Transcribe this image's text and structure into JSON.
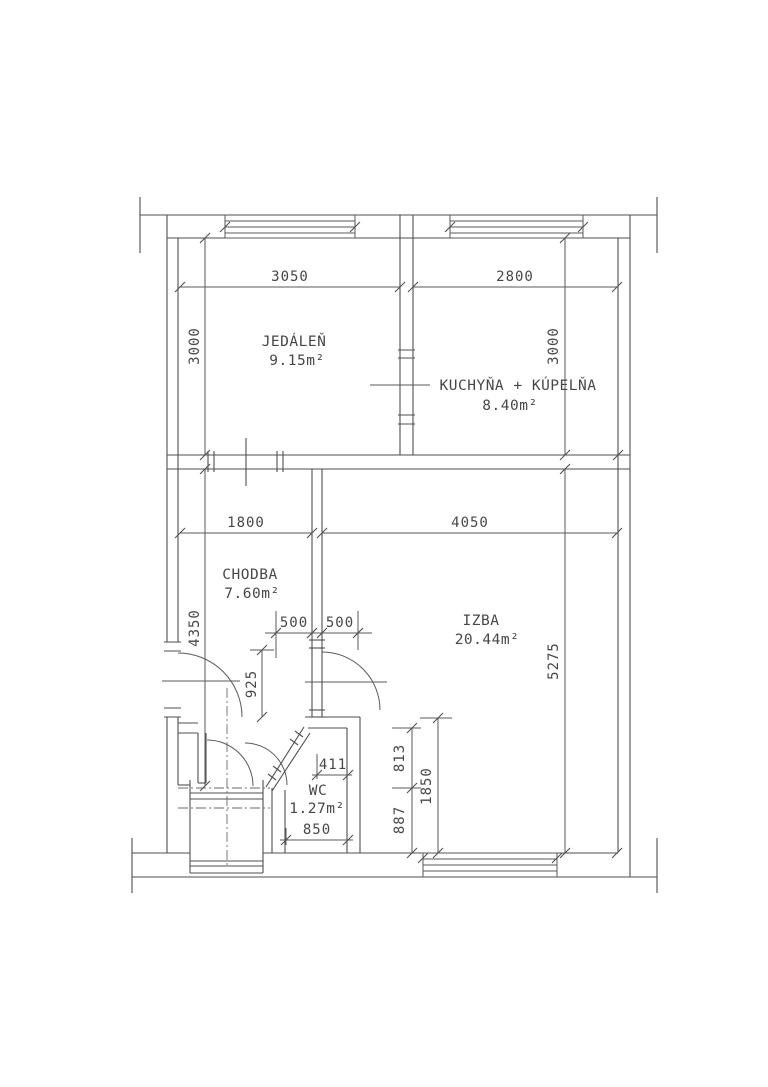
{
  "floor_plan": {
    "rooms": {
      "jedalen": {
        "name": "JEDÁLEŇ",
        "area": "9.15m²"
      },
      "kuchyna": {
        "name": "KUCHYŇA  +  KÚPELŇA",
        "area": "8.40m²"
      },
      "chodba": {
        "name": "CHODBA",
        "area": "7.60m²"
      },
      "izba": {
        "name": "IZBA",
        "area": "20.44m²"
      },
      "wc": {
        "name": "WC",
        "area": "1.27m²"
      }
    },
    "dimensions_mm": {
      "jedalen_width": "3050",
      "kuchyna_width": "2800",
      "jedalen_height": "3000",
      "kuchyna_height": "3000",
      "chodba_width": "1800",
      "izba_width": "4050",
      "chodba_height": "4350",
      "izba_height": "5275",
      "door_left": "500",
      "door_right": "500",
      "chodba_offset": "925",
      "wc_top": "411",
      "wc_bottom": "850",
      "izba_seg_top": "813",
      "izba_seg_bot": "887",
      "izba_seg_total": "1850"
    }
  }
}
